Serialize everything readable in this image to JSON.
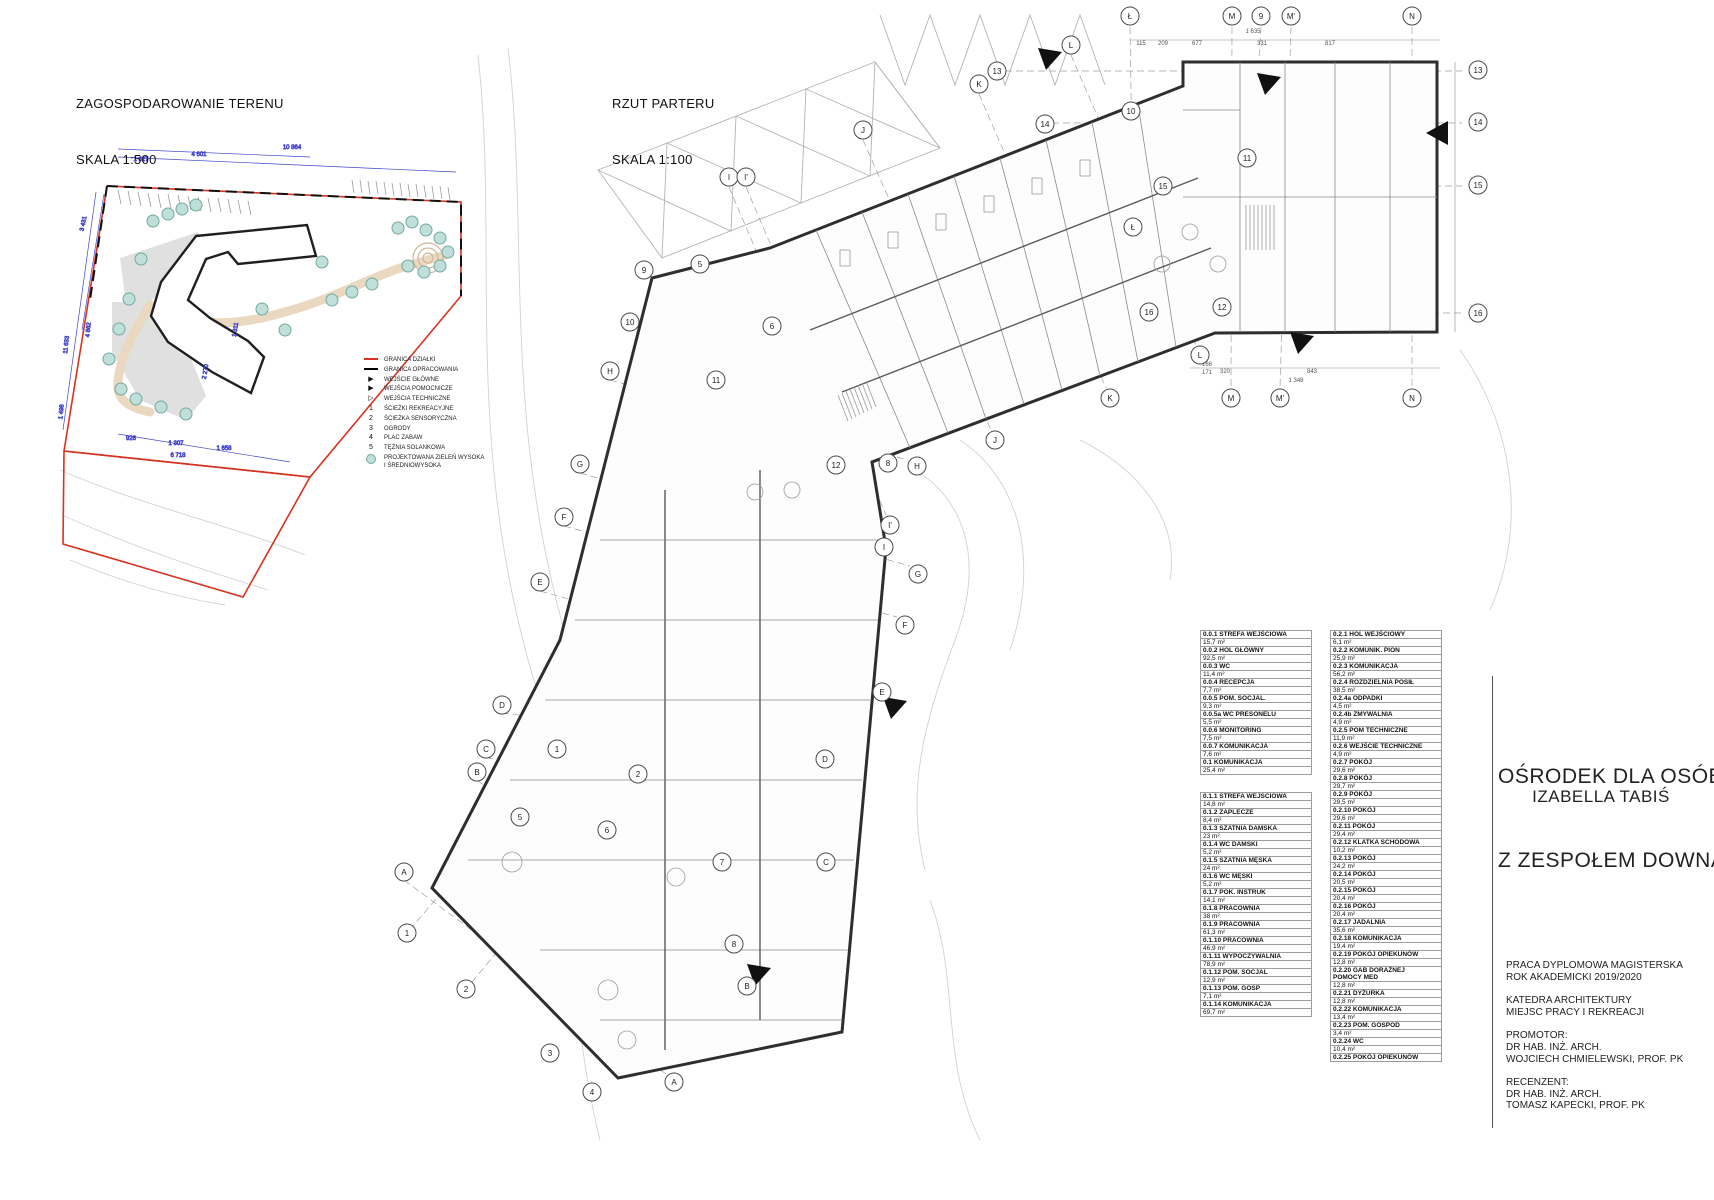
{
  "site_plan": {
    "title": "ZAGOSPODAROWANIE TERENU",
    "scale_label": "SKALA 1:500",
    "legend": [
      {
        "icon": "red-line",
        "label": "GRANICA DZIAŁKI"
      },
      {
        "icon": "black-line",
        "label": "GRANICA OPRACOWANIA"
      },
      {
        "icon": "triangle-filled",
        "label": "WEJŚCIE GŁÓWNE"
      },
      {
        "icon": "triangle-filled",
        "label": "WEJŚCIA POMOCNICZE"
      },
      {
        "icon": "triangle-outline",
        "label": "WEJŚCIA TECHNICZNE"
      },
      {
        "icon": "number",
        "num": "1",
        "label": "ŚCIEŻKI REKREACYJNE"
      },
      {
        "icon": "number",
        "num": "2",
        "label": "ŚCIEŻKA SENSORYCZNA"
      },
      {
        "icon": "number",
        "num": "3",
        "label": "OGRODY"
      },
      {
        "icon": "number",
        "num": "4",
        "label": "PLAC ZABAW"
      },
      {
        "icon": "number",
        "num": "5",
        "label": "TĘŻNIA SOLANKOWA"
      },
      {
        "icon": "greenery-circle",
        "label": "PROJEKTOWANA ZIELEŃ WYSOKA\nI ŚREDNIOWYSOKA"
      }
    ],
    "dimension_labels": [
      {
        "text": "1 627",
        "x": 141,
        "y": 161,
        "rot": 0
      },
      {
        "text": "4 601",
        "x": 199,
        "y": 156,
        "rot": 0
      },
      {
        "text": "10 864",
        "x": 292,
        "y": 149,
        "rot": 0
      },
      {
        "text": "3 431",
        "x": 85,
        "y": 224,
        "rot": -78
      },
      {
        "text": "4 862",
        "x": 90,
        "y": 330,
        "rot": -84
      },
      {
        "text": "11 633",
        "x": 68,
        "y": 345,
        "rot": -84
      },
      {
        "text": "1 498",
        "x": 63,
        "y": 412,
        "rot": -84
      },
      {
        "text": "2 270",
        "x": 207,
        "y": 372,
        "rot": -80
      },
      {
        "text": "1 311",
        "x": 237,
        "y": 330,
        "rot": -80
      },
      {
        "text": "926",
        "x": 131,
        "y": 440,
        "rot": 0
      },
      {
        "text": "1 307",
        "x": 176,
        "y": 445,
        "rot": 0
      },
      {
        "text": "1 658",
        "x": 224,
        "y": 450,
        "rot": 0
      },
      {
        "text": "6 718",
        "x": 178,
        "y": 457,
        "rot": 0
      }
    ],
    "colors": {
      "boundary_red": "#d63322",
      "dimension_blue": "#4343cc",
      "tree_fill": "#bfe0da",
      "tree_stroke": "#76a89e",
      "path_tan": "#ead9c0"
    }
  },
  "floor_plan": {
    "title": "RZUT PARTERU",
    "scale_label": "SKALA 1:100",
    "grid_bubbles": [
      {
        "label": "Ł",
        "x": 1130,
        "y": 16
      },
      {
        "label": "M",
        "x": 1232,
        "y": 16
      },
      {
        "label": "9",
        "x": 1261,
        "y": 16
      },
      {
        "label": "M'",
        "x": 1291,
        "y": 16
      },
      {
        "label": "N",
        "x": 1412,
        "y": 16
      },
      {
        "label": "L",
        "x": 1071,
        "y": 45
      },
      {
        "label": "13",
        "x": 997,
        "y": 71
      },
      {
        "label": "K",
        "x": 979,
        "y": 84
      },
      {
        "label": "10",
        "x": 1131,
        "y": 111
      },
      {
        "label": "14",
        "x": 1045,
        "y": 124
      },
      {
        "label": "J",
        "x": 863,
        "y": 130
      },
      {
        "label": "11",
        "x": 1247,
        "y": 158
      },
      {
        "label": "I",
        "x": 729,
        "y": 177
      },
      {
        "label": "I'",
        "x": 746,
        "y": 177
      },
      {
        "label": "15",
        "x": 1163,
        "y": 186
      },
      {
        "label": "Ł",
        "x": 1133,
        "y": 227
      },
      {
        "label": "13",
        "x": 1478,
        "y": 70
      },
      {
        "label": "14",
        "x": 1478,
        "y": 122
      },
      {
        "label": "15",
        "x": 1478,
        "y": 185
      },
      {
        "label": "16",
        "x": 1478,
        "y": 313
      },
      {
        "label": "9",
        "x": 644,
        "y": 270
      },
      {
        "label": "5",
        "x": 700,
        "y": 264
      },
      {
        "label": "10",
        "x": 630,
        "y": 322
      },
      {
        "label": "6",
        "x": 772,
        "y": 326
      },
      {
        "label": "H",
        "x": 610,
        "y": 371
      },
      {
        "label": "11",
        "x": 716,
        "y": 380
      },
      {
        "label": "16",
        "x": 1149,
        "y": 312
      },
      {
        "label": "12",
        "x": 1222,
        "y": 307
      },
      {
        "label": "L",
        "x": 1200,
        "y": 355
      },
      {
        "label": "M",
        "x": 1231,
        "y": 398
      },
      {
        "label": "M'",
        "x": 1280,
        "y": 398
      },
      {
        "label": "N",
        "x": 1412,
        "y": 398
      },
      {
        "label": "K",
        "x": 1110,
        "y": 398
      },
      {
        "label": "J",
        "x": 995,
        "y": 440
      },
      {
        "label": "G",
        "x": 580,
        "y": 464
      },
      {
        "label": "12",
        "x": 836,
        "y": 465
      },
      {
        "label": "8",
        "x": 888,
        "y": 463
      },
      {
        "label": "H",
        "x": 917,
        "y": 466
      },
      {
        "label": "F",
        "x": 564,
        "y": 517
      },
      {
        "label": "I'",
        "x": 890,
        "y": 525
      },
      {
        "label": "I",
        "x": 884,
        "y": 547
      },
      {
        "label": "E",
        "x": 540,
        "y": 582
      },
      {
        "label": "G",
        "x": 918,
        "y": 574
      },
      {
        "label": "F",
        "x": 905,
        "y": 625
      },
      {
        "label": "D",
        "x": 502,
        "y": 705
      },
      {
        "label": "E",
        "x": 882,
        "y": 692
      },
      {
        "label": "C",
        "x": 486,
        "y": 749
      },
      {
        "label": "1",
        "x": 557,
        "y": 749
      },
      {
        "label": "B",
        "x": 477,
        "y": 772
      },
      {
        "label": "2",
        "x": 638,
        "y": 774
      },
      {
        "label": "D",
        "x": 825,
        "y": 759
      },
      {
        "label": "5",
        "x": 520,
        "y": 817
      },
      {
        "label": "6",
        "x": 607,
        "y": 830
      },
      {
        "label": "7",
        "x": 722,
        "y": 862
      },
      {
        "label": "A",
        "x": 404,
        "y": 872
      },
      {
        "label": "C",
        "x": 826,
        "y": 862
      },
      {
        "label": "1",
        "x": 407,
        "y": 933
      },
      {
        "label": "8",
        "x": 734,
        "y": 944
      },
      {
        "label": "B",
        "x": 747,
        "y": 986
      },
      {
        "label": "2",
        "x": 466,
        "y": 989
      },
      {
        "label": "3",
        "x": 550,
        "y": 1053
      },
      {
        "label": "A",
        "x": 674,
        "y": 1082
      },
      {
        "label": "4",
        "x": 592,
        "y": 1092
      }
    ],
    "dimension_labels": [
      {
        "text": "1 635",
        "x": 1253,
        "y": 33,
        "rot": 0
      },
      {
        "text": "115",
        "x": 1141,
        "y": 45,
        "rot": 0
      },
      {
        "text": "209",
        "x": 1163,
        "y": 45,
        "rot": 0
      },
      {
        "text": "677",
        "x": 1197,
        "y": 45,
        "rot": 0
      },
      {
        "text": "331",
        "x": 1262,
        "y": 45,
        "rot": 0
      },
      {
        "text": "817",
        "x": 1330,
        "y": 45,
        "rot": 0
      },
      {
        "text": "166",
        "x": 1207,
        "y": 366,
        "rot": 0
      },
      {
        "text": "171",
        "x": 1207,
        "y": 374,
        "rot": 0
      },
      {
        "text": "320",
        "x": 1225,
        "y": 373,
        "rot": 0
      },
      {
        "text": "843",
        "x": 1312,
        "y": 373,
        "rot": 0
      },
      {
        "text": "1 348",
        "x": 1296,
        "y": 382,
        "rot": 0
      }
    ]
  },
  "room_tables": {
    "zone_0_0": [
      {
        "no": "0.0.1",
        "name": "STREFA WEJŚCIOWA",
        "area": "15,7 m²"
      },
      {
        "no": "0.0.2",
        "name": "HOL GŁÓWNY",
        "area": "92,5 m²"
      },
      {
        "no": "0.0.3",
        "name": "WC",
        "area": "11,4 m²"
      },
      {
        "no": "0.0.4",
        "name": "RECEPCJA",
        "area": "7,7 m²"
      },
      {
        "no": "0.0.5",
        "name": "POM. SOCJAL.",
        "area": "9,3 m²"
      },
      {
        "no": "0.0.5a",
        "name": "WC PRESONELU",
        "area": "5,5 m²"
      },
      {
        "no": "0.0.6",
        "name": "MONITORING",
        "area": "7,5 m²"
      },
      {
        "no": "0.0.7",
        "name": "KOMUNIKACJA",
        "area": "7,6 m²"
      },
      {
        "no": "0.1",
        "name": "KOMUNIKACJA",
        "area": "25,4 m²"
      }
    ],
    "zone_0_1": [
      {
        "no": "0.1.1",
        "name": "STREFA WEJSCIOWA",
        "area": "14,8 m²"
      },
      {
        "no": "0.1.2",
        "name": "ZAPLECZE",
        "area": "8,4 m²"
      },
      {
        "no": "0.1.3",
        "name": "SZATNIA DAMSKA",
        "area": "23 m²"
      },
      {
        "no": "0.1.4",
        "name": "WC DAMSKI",
        "area": "5,2 m²"
      },
      {
        "no": "0.1.5",
        "name": "SZATNIA MĘSKA",
        "area": "24 m²"
      },
      {
        "no": "0.1.6",
        "name": "WC MĘSKI",
        "area": "5,2 m²"
      },
      {
        "no": "0.1.7",
        "name": "POK. INSTRUK",
        "area": "14,1 m²"
      },
      {
        "no": "0.1.8",
        "name": "PRACOWNIA",
        "area": "38 m²"
      },
      {
        "no": "0.1.9",
        "name": "PRACOWNIA",
        "area": "61,3 m²"
      },
      {
        "no": "0.1.10",
        "name": "PRACOWNIA",
        "area": "46,9 m²"
      },
      {
        "no": "0.1.11",
        "name": "WYPOCZYWALNIA",
        "area": "78,9 m²"
      },
      {
        "no": "0.1.12",
        "name": "POM. SOCJAL",
        "area": "12,9 m²"
      },
      {
        "no": "0.1.13",
        "name": "POM. GOSP",
        "area": "7,1 m²"
      },
      {
        "no": "0.1.14",
        "name": "KOMUNIKACJA",
        "area": "69,7 m²"
      }
    ],
    "zone_0_2": [
      {
        "no": "0.2.1",
        "name": "HOL WEJŚCIOWY",
        "area": "6,1 m²"
      },
      {
        "no": "0.2.2",
        "name": "KOMUNIK. PION",
        "area": "25,9 m²"
      },
      {
        "no": "0.2.3",
        "name": "KOMUNIKACJA",
        "area": "56,2 m²"
      },
      {
        "no": "0.2.4",
        "name": "ROZDZIELNIA POSIŁ",
        "area": "38,5 m²"
      },
      {
        "no": "0.2.4a",
        "name": "ODPADKI",
        "area": "4,5 m²"
      },
      {
        "no": "0.2.4b",
        "name": "ZMYWALNIA",
        "area": "4,9 m²"
      },
      {
        "no": "0.2.5",
        "name": "POM TECHNICZNE",
        "area": "11,9 m²"
      },
      {
        "no": "0.2.6",
        "name": "WEJŚCIE TECHNICZNE",
        "area": "4,9 m²"
      },
      {
        "no": "0.2.7",
        "name": "POKÓJ",
        "area": "29,6 m²"
      },
      {
        "no": "0.2.8",
        "name": "POKÓJ",
        "area": "29,7 m²"
      },
      {
        "no": "0.2.9",
        "name": "POKÓJ",
        "area": "29,5 m²"
      },
      {
        "no": "0.2.10",
        "name": "POKÓJ",
        "area": "29,6 m²"
      },
      {
        "no": "0.2.11",
        "name": "POKÓJ",
        "area": "29,4 m²"
      },
      {
        "no": "0.2.12",
        "name": "KLATKA SCHODOWA",
        "area": "10,2 m²"
      },
      {
        "no": "0.2.13",
        "name": "POKÓJ",
        "area": "24,2 m²"
      },
      {
        "no": "0.2.14",
        "name": "POKÓJ",
        "area": "20,5 m²"
      },
      {
        "no": "0.2.15",
        "name": "POKÓJ",
        "area": "20,4 m²"
      },
      {
        "no": "0.2.16",
        "name": "POKÓJ",
        "area": "20,4 m²"
      },
      {
        "no": "0.2.17",
        "name": "JADALNIA",
        "area": "35,6 m²"
      },
      {
        "no": "0.2.18",
        "name": "KOMUNIKACJA",
        "area": "19,4 m²"
      },
      {
        "no": "0.2.19",
        "name": "POKÓJ OPIEKUNÓW",
        "area": "12,8 m²"
      },
      {
        "no": "0.2.20",
        "name": "GAB DORAŻNEJ\nPOMOCY MED",
        "area": "12,8 m²"
      },
      {
        "no": "0.2.21",
        "name": "DYŻURKA",
        "area": "12,8 m²"
      },
      {
        "no": "0.2.22",
        "name": "KOMUNIKACJA",
        "area": "13,4 m²"
      },
      {
        "no": "0.2.23",
        "name": "POM. GOSPOD",
        "area": "3,4 m²"
      },
      {
        "no": "0.2.24",
        "name": "WC",
        "area": "10,4 m²"
      },
      {
        "no": "0.2.25",
        "name": "POKÓJ OPIEKUNÓW",
        "area": ""
      }
    ]
  },
  "title_block": {
    "project_title_line1": "OŚRODEK DLA OSÓB",
    "project_title_line2": "Z ZESPOŁEM DOWNA",
    "author": "IZABELLA TABIŚ",
    "info_lines": [
      "PRACA DYPLOMOWA MAGISTERSKA",
      "ROK AKADEMICKI 2019/2020",
      "",
      "KATEDRA ARCHITEKTURY",
      "MIEJSC PRACY I REKREACJI",
      "",
      "PROMOTOR:",
      "DR HAB. INŻ. ARCH.",
      "WOJCIECH CHMIELEWSKI, PROF. PK",
      "",
      "RECENZENT:",
      "DR HAB. INŻ. ARCH.",
      "TOMASZ KAPECKI, PROF. PK"
    ]
  }
}
